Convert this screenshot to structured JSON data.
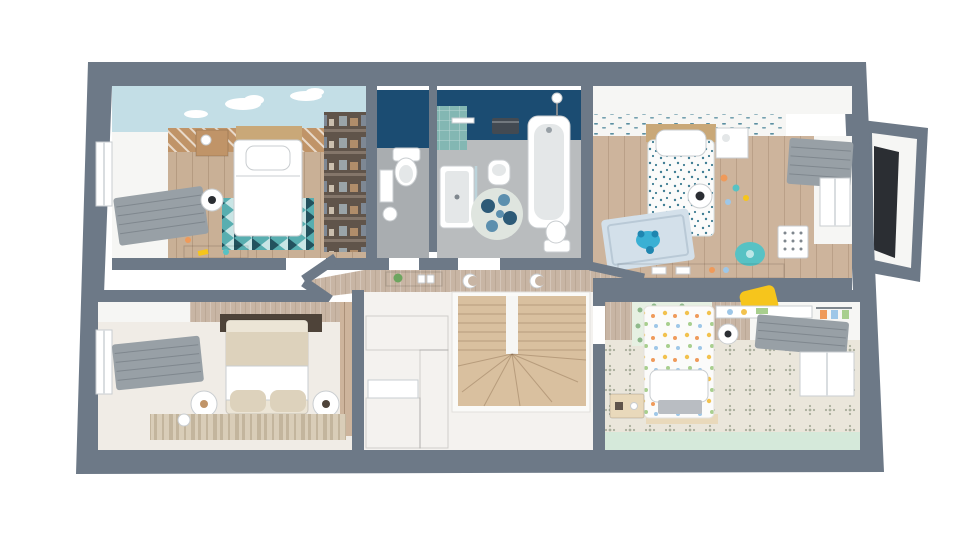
{
  "meta": {
    "description": "3D top-down render of an upper-storey house floor plan with three single bedrooms, a master bedroom, bathroom, separate WC, dressing nook and a central landing with U-shaped staircase",
    "view": "top-down 3D dollhouse render, no visible text"
  },
  "colors": {
    "exterior_bg": "#ffffff",
    "wall_gray": "#6d7987",
    "wall_gray_dark": "#5a6673",
    "wall_face_white": "#f6f6f4",
    "navy_wall": "#1b4c72",
    "teal_tile": "#83b7b3",
    "sky_wallpaper": "#c3dee6",
    "cloud_white": "#ffffff",
    "wood_floor_1": "#c9b096",
    "wood_floor_2": "#cdb49c",
    "wood_warm": "#c09468",
    "wood_headboard": "#c9a878",
    "wood_light": "#e9d9bb",
    "stair_wood": "#d9c09f",
    "bath_floor": "#b9bcbe",
    "wc_floor": "#a9adb0",
    "hall_wall_tan": "#c8b5a4",
    "hall_floor": "#f4f2ef",
    "rug_teal": "#58aeb0",
    "rug_teal_dark": "#23525e",
    "rug_blue_light": "#d3e0ea",
    "rug_master": "#d9cdb8",
    "rug_master_stripe": "#c3b59d",
    "duvet_white": "#fbfbfa",
    "duvet_dot_teal": "#3f7d93",
    "master_bed_cream": "#ece5d6",
    "master_bed_fold": "#ddd2bc",
    "master_headboard": "#4e4339",
    "master_floor": "#f0ece6",
    "bed3_tile_floor": "#eae6db",
    "tile_motif": "#a9ae9c",
    "mint_floor": "#d5e9da",
    "decal_green_bg": "#e6f0e2",
    "decal_green": "#8fb98b",
    "pastel_yellow": "#f2c24e",
    "pastel_orange": "#ef9a5a",
    "pastel_green": "#a8cf8e",
    "pastel_blue": "#9ec7e8",
    "chair_yellow": "#f6c51c",
    "chair_teal": "#57c2c4",
    "toy_blue": "#3ab0d4",
    "toy_blue_dark": "#1f86b0",
    "curtain_gray": "#98a0a6",
    "curtain_gray_dark": "#7f878e",
    "window_frame": "#d9dde0",
    "dark_panel": "#2b2e33",
    "wardrobe_dark": "#60544a",
    "wardrobe_shelf": "#84766a",
    "towel_dark": "#434a52",
    "fixture_white": "#ffffff",
    "fixture_gray": "#e4e7e8",
    "fixture_stroke": "#c9cdd0",
    "plant_green": "#6da55f",
    "floral_blue_1": "#2d5a77",
    "floral_blue_2": "#5c8fae",
    "floral_rug_bg": "#dfe5df"
  },
  "scene": {
    "rooms": [
      {
        "id": "bedroom-1",
        "position": "top-left",
        "features": [
          "cloud-sky accent wallpaper",
          "wood slat headboard wall",
          "single bed with white duvet",
          "teal geometric zigzag rug",
          "wood nightstand",
          "white drum floor lamp",
          "window with gray venetian blind",
          "small toy desk",
          "scattered yellow toys"
        ]
      },
      {
        "id": "dressing-nook",
        "position": "top-center-left",
        "features": [
          "dark open wardrobe shelving with folded clothes"
        ]
      },
      {
        "id": "wc",
        "position": "top-center",
        "features": [
          "navy accent wall",
          "toilet with cistern",
          "wall picture frame",
          "pedestal bin"
        ]
      },
      {
        "id": "bathroom",
        "position": "top-center",
        "features": [
          "navy accent wall",
          "teal tiled shower wall with rain head",
          "walk-in shower tray with glass screen",
          "pedestal washbasin",
          "bathtub",
          "round blue floral rug",
          "dark towel rail",
          "toilet"
        ]
      },
      {
        "id": "bedroom-2",
        "position": "top-right",
        "features": [
          "patterned wallpaper frieze",
          "single bed with teal speckle duvet",
          "white nightstand",
          "rattan ball lamp",
          "light-blue play rug",
          "blue crab toy",
          "teal chair",
          "wall organiser",
          "desk with toys",
          "window with gray curtain"
        ]
      },
      {
        "id": "master-bedroom",
        "position": "bottom-left",
        "features": [
          "striped tan wallpaper",
          "vertical wood plank accent wall",
          "dark brown headboard panel",
          "double bed with cream bedding and two pillows",
          "two round white nightstands",
          "striped beige runner rug",
          "window with gray curtain"
        ]
      },
      {
        "id": "landing-hall",
        "position": "center-bottom",
        "features": [
          "tan papered walls",
          "two crescent-moon wall lights",
          "console shelf with plant and light switches",
          "C-shaped light-wood wardrobe unit",
          "U-shaped winder staircase in light wood"
        ]
      },
      {
        "id": "bedroom-3",
        "position": "bottom-right",
        "features": [
          "green leaf headboard decal",
          "single bed with pastel dot duvet",
          "paper ball lamp",
          "yellow chair",
          "wall desk shelf",
          "hanging clothes rail",
          "patterned cement-tile floor",
          "mint floor band",
          "wood toy box",
          "window with gray curtain"
        ]
      },
      {
        "id": "bay-window",
        "position": "right-exterior",
        "features": [
          "projecting bay with dark glazed panel"
        ]
      }
    ]
  }
}
